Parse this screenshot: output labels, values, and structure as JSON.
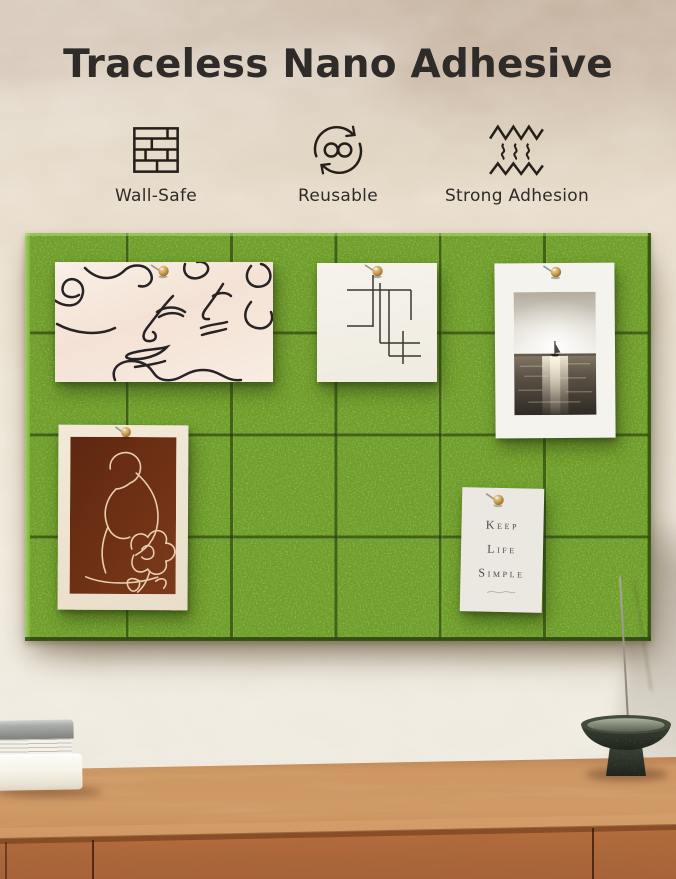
{
  "title": "Traceless Nano Adhesive",
  "features": [
    {
      "label": "Wall-Safe",
      "icon": "brick-wall-icon"
    },
    {
      "label": "Reusable",
      "icon": "reuse-arrows-infinity-icon"
    },
    {
      "label": "Strong Adhesion",
      "icon": "adhesion-zigzag-icon"
    }
  ],
  "board": {
    "tile_rows": 4,
    "tile_columns": 6,
    "tile_count": 24,
    "felt_color": "#74a530",
    "seam_color": "#1e3207"
  },
  "pinned_items": [
    {
      "name": "abstract-faces-line-art",
      "type": "artwork",
      "pin": "wooden-push-pin"
    },
    {
      "name": "geometric-line-sketch",
      "type": "artwork",
      "pin": "wooden-push-pin"
    },
    {
      "name": "sailboat-seascape-photo",
      "type": "photo",
      "pin": "wooden-push-pin"
    },
    {
      "name": "reclining-figure-line-art",
      "type": "artwork",
      "pin": "wooden-push-pin"
    },
    {
      "name": "quote-card",
      "type": "card",
      "pin": "wooden-push-pin",
      "lines": [
        "Keep",
        "Life",
        "Simple"
      ]
    }
  ],
  "scene": {
    "furniture": "wood-sideboard",
    "props": [
      "stacked-books",
      "incense-pedestal-bowl",
      "incense-stick"
    ]
  },
  "palette": {
    "wall_top": "#c8b6a4",
    "wall_light": "#f1ebdf",
    "text_dark": "#2f2b28",
    "icon_stroke": "#241f19",
    "wood_top": "#cf9a66",
    "wood_front": "#b97343"
  }
}
